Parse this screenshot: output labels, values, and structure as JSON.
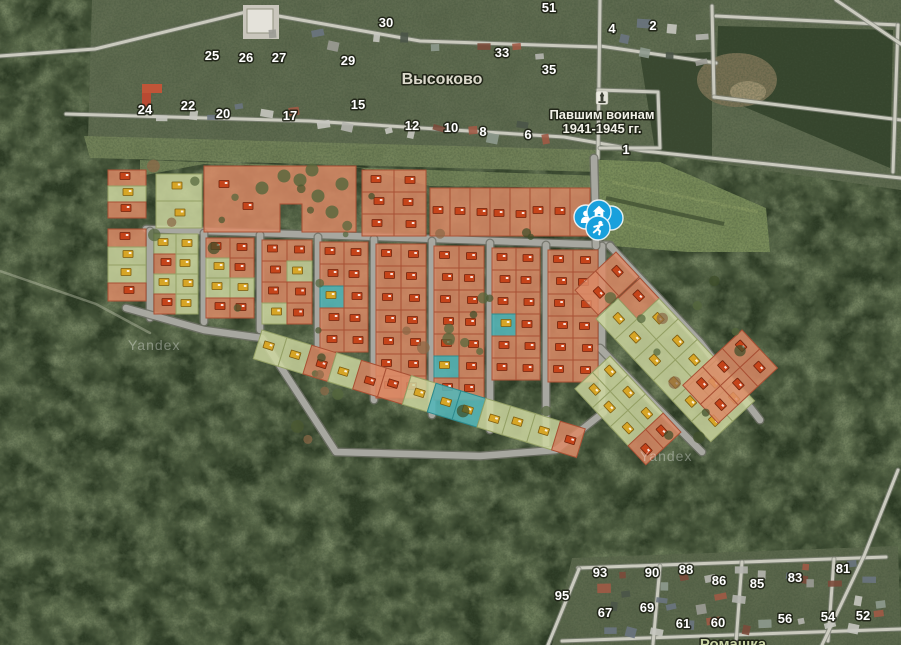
{
  "map": {
    "attribution": "Yandex",
    "watermarks": [
      {
        "x": 128,
        "y": 350
      },
      {
        "x": 640,
        "y": 461
      }
    ],
    "settlement_labels": [
      {
        "id": "vysokovo",
        "text": "Высоково",
        "x": 442,
        "y": 84,
        "cls": "place"
      },
      {
        "id": "romashka",
        "text": "Ромашка",
        "x": 733,
        "y": 649,
        "cls": "place2"
      }
    ],
    "memorial": {
      "line1": "Павшим воинам",
      "line2": "1941-1945 гг.",
      "x": 602,
      "y1": 119,
      "y2": 133,
      "icon": {
        "x": 602,
        "y": 98
      }
    },
    "house_numbers": [
      {
        "n": "30",
        "x": 386,
        "y": 27
      },
      {
        "n": "51",
        "x": 549,
        "y": 12
      },
      {
        "n": "4",
        "x": 612,
        "y": 33
      },
      {
        "n": "2",
        "x": 653,
        "y": 30
      },
      {
        "n": "25",
        "x": 212,
        "y": 60
      },
      {
        "n": "26",
        "x": 246,
        "y": 62
      },
      {
        "n": "27",
        "x": 279,
        "y": 62
      },
      {
        "n": "29",
        "x": 348,
        "y": 65
      },
      {
        "n": "33",
        "x": 502,
        "y": 57
      },
      {
        "n": "35",
        "x": 549,
        "y": 74
      },
      {
        "n": "24",
        "x": 145,
        "y": 114
      },
      {
        "n": "22",
        "x": 188,
        "y": 110
      },
      {
        "n": "20",
        "x": 223,
        "y": 118
      },
      {
        "n": "17",
        "x": 290,
        "y": 120
      },
      {
        "n": "15",
        "x": 358,
        "y": 109
      },
      {
        "n": "12",
        "x": 412,
        "y": 130
      },
      {
        "n": "10",
        "x": 451,
        "y": 132
      },
      {
        "n": "8",
        "x": 483,
        "y": 136
      },
      {
        "n": "6",
        "x": 528,
        "y": 139
      },
      {
        "n": "1",
        "x": 626,
        "y": 154
      },
      {
        "n": "93",
        "x": 600,
        "y": 577
      },
      {
        "n": "90",
        "x": 652,
        "y": 577
      },
      {
        "n": "88",
        "x": 686,
        "y": 574
      },
      {
        "n": "86",
        "x": 719,
        "y": 585
      },
      {
        "n": "85",
        "x": 757,
        "y": 588
      },
      {
        "n": "83",
        "x": 795,
        "y": 582
      },
      {
        "n": "81",
        "x": 843,
        "y": 573
      },
      {
        "n": "95",
        "x": 562,
        "y": 600
      },
      {
        "n": "67",
        "x": 605,
        "y": 617
      },
      {
        "n": "69",
        "x": 647,
        "y": 612
      },
      {
        "n": "61",
        "x": 683,
        "y": 628
      },
      {
        "n": "60",
        "x": 718,
        "y": 627
      },
      {
        "n": "56",
        "x": 785,
        "y": 623
      },
      {
        "n": "54",
        "x": 828,
        "y": 621
      },
      {
        "n": "52",
        "x": 863,
        "y": 620
      }
    ],
    "markers": [
      {
        "icon": "circle",
        "x": 611,
        "y": 218
      },
      {
        "icon": "person",
        "x": 586,
        "y": 217
      },
      {
        "icon": "home",
        "x": 599,
        "y": 212
      },
      {
        "icon": "runner",
        "x": 598,
        "y": 228
      }
    ],
    "marker_color": "#18a0dc",
    "village_roads": [
      "66,114 310,121 564,137 644,151 901,178",
      "0,56 95,49 250,11 420,41 598,47",
      "600,46 716,63",
      "600,0 598,158",
      "598,90 658,92 660,148 600,148",
      "712,6 714,97",
      "714,97 901,120",
      "716,16 898,25",
      "898,25 893,172",
      "836,0 901,44",
      "578,568 886,557",
      "562,641 901,629",
      "548,645 579,569",
      "660,566 653,644",
      "742,562 736,643",
      "834,559 828,641",
      "898,470 864,556 822,645"
    ],
    "trails": [
      "0,271 96,304 150,333"
    ],
    "development": {
      "roads": [
        "146,229 610,245",
        "150,231 150,318",
        "204,233 204,322",
        "260,235 260,330",
        "318,237 318,345",
        "374,239 374,400",
        "432,241 432,415",
        "490,243 490,430",
        "546,245 546,445",
        "602,246 602,412",
        "126,308 204,330 262,338 336,452 480,456 556,450 604,412",
        "594,158 596,246",
        "610,246 700,342 760,420",
        "600,348 654,404 702,452"
      ],
      "blocks": [
        {
          "name": "west-strip-north",
          "x": 108,
          "y": 170,
          "cw": 38,
          "ch": 16,
          "rot": 0,
          "cells": [
            "o",
            "g",
            "o"
          ]
        },
        {
          "name": "west-strip-south",
          "x": 108,
          "y": 229,
          "cw": 38,
          "ch": 18,
          "rot": 0,
          "cells": [
            "o",
            "g",
            "g",
            "o"
          ]
        },
        {
          "name": "north-green-pair",
          "x": 156,
          "y": 174,
          "cw": 46,
          "ch": 27,
          "rot": 0,
          "cells": [
            "g",
            "g"
          ]
        },
        {
          "name": "north-large-plot",
          "poly": "204,166 356,166 356,232 302,232 302,204 280,204 280,232 204,232",
          "fill": "o",
          "houses": [
            [
              224,
              184
            ],
            [
              248,
              206
            ]
          ],
          "trees": [
            [
              300,
              180
            ],
            [
              318,
              196
            ],
            [
              284,
              176
            ],
            [
              332,
              212
            ],
            [
              262,
              188
            ],
            [
              312,
              170
            ],
            [
              342,
              184
            ]
          ]
        },
        {
          "name": "north-mid",
          "x": 362,
          "y": 170,
          "cw": 32,
          "ch": 22,
          "rot": 0,
          "cells": [
            "oo",
            "oo",
            "oo"
          ]
        },
        {
          "name": "north-row",
          "x": 430,
          "y": 188,
          "cw": 20,
          "ch": 48,
          "rot": 0,
          "cells": [
            "oooooooo"
          ]
        },
        {
          "name": "col-1",
          "x": 154,
          "y": 234,
          "cw": 22,
          "ch": 20,
          "rot": 0,
          "cells": [
            "gg",
            "og",
            "gg",
            "og"
          ]
        },
        {
          "name": "col-2",
          "x": 206,
          "y": 238,
          "cw": 24,
          "ch": 20,
          "rot": 0,
          "cells": [
            "oo",
            "go",
            "gg",
            "oo"
          ]
        },
        {
          "name": "col-3",
          "x": 262,
          "y": 240,
          "cw": 25,
          "ch": 21,
          "rot": 0,
          "cells": [
            "oo",
            "og",
            "oo",
            "go"
          ]
        },
        {
          "name": "col-4",
          "x": 320,
          "y": 242,
          "cw": 24,
          "ch": 22,
          "rot": 0,
          "cells": [
            "oo",
            "oo",
            "to",
            "oo",
            "oo"
          ]
        },
        {
          "name": "col-5",
          "x": 376,
          "y": 244,
          "cw": 25,
          "ch": 22,
          "rot": 0,
          "cells": [
            "oo",
            "oo",
            "oo",
            "oo",
            "oo",
            "oo",
            "oo"
          ]
        },
        {
          "name": "col-6",
          "x": 434,
          "y": 246,
          "cw": 25,
          "ch": 22,
          "rot": 0,
          "cells": [
            "oo",
            "oo",
            "oo",
            "oo",
            "oo",
            "to",
            "oo"
          ]
        },
        {
          "name": "col-7",
          "x": 492,
          "y": 248,
          "cw": 24,
          "ch": 22,
          "rot": 0,
          "cells": [
            "oo",
            "oo",
            "oo",
            "to",
            "oo",
            "oo"
          ]
        },
        {
          "name": "col-8",
          "x": 548,
          "y": 250,
          "cw": 25,
          "ch": 22,
          "rot": 0,
          "cells": [
            "oo",
            "oo",
            "oo",
            "oo",
            "oo",
            "oo"
          ]
        },
        {
          "name": "south-fringe",
          "x": 262,
          "y": 330,
          "cw": 26,
          "ch": 30,
          "rot": 17,
          "cells": [
            "ggogoogttgggo"
          ]
        },
        {
          "name": "east-band-start",
          "x": 616,
          "y": 252,
          "cw": 34,
          "ch": 28,
          "rot": 47,
          "cells": [
            "o",
            "o"
          ]
        },
        {
          "name": "east-green-band",
          "x": 640,
          "y": 278,
          "cw": 28,
          "ch": 30,
          "rot": 47,
          "cells": [
            "oggggg",
            "gggggg"
          ]
        },
        {
          "name": "east-lower-band",
          "x": 610,
          "y": 356,
          "cw": 26,
          "ch": 24,
          "rot": 47,
          "cells": [
            "gggo",
            "gggo"
          ]
        },
        {
          "name": "east-orange-cluster",
          "x": 742,
          "y": 330,
          "cw": 26,
          "ch": 27,
          "rot": 47,
          "cells": [
            "oo",
            "oo",
            "oo"
          ]
        }
      ]
    }
  }
}
